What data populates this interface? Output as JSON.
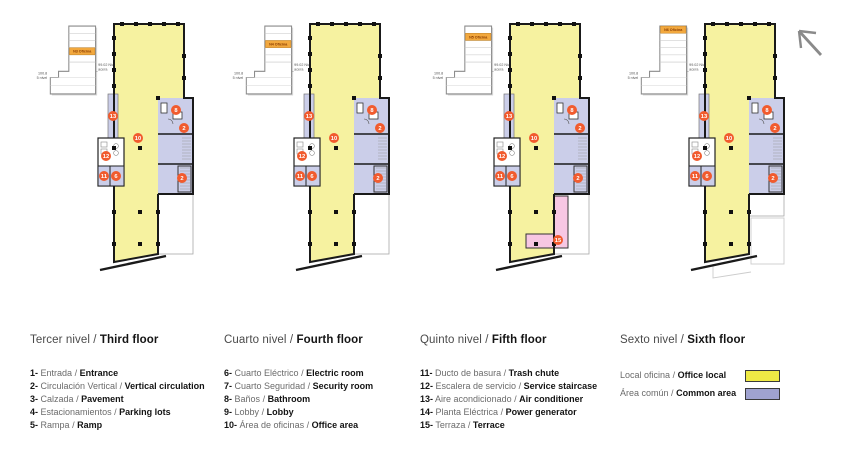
{
  "ui": {
    "separator": "/"
  },
  "colors": {
    "office_yellow": "#F6F2A0",
    "common_lavender": "#CBCEE9",
    "terrace_pink": "#F7C7E3",
    "marker_orange": "#F15B2E",
    "swatch_yellow": "#EFEA45",
    "swatch_lavender": "#9FA2D0",
    "wall": "#1a1a1a",
    "band_orange": "#F2A83E",
    "band_text": "#8a3c00"
  },
  "panels": [
    {
      "inset": {
        "band_label": "N3 Oficina",
        "left_label_1": "100.8",
        "left_label_2": "5 nivel",
        "right_label_1": "99.02 Nivel",
        "right_label_2": "acera"
      },
      "floor": 3,
      "terrace": false,
      "ghost": false,
      "markers": [
        {
          "n": "13",
          "x": 17,
          "y": 100
        },
        {
          "n": "12",
          "x": 10,
          "y": 140
        },
        {
          "n": "11",
          "x": 8,
          "y": 160
        },
        {
          "n": "6",
          "x": 20,
          "y": 160
        },
        {
          "n": "10",
          "x": 42,
          "y": 122
        },
        {
          "n": "8",
          "x": 80,
          "y": 94
        },
        {
          "n": "2",
          "x": 88,
          "y": 112
        },
        {
          "n": "2",
          "x": 86,
          "y": 162
        }
      ]
    },
    {
      "inset": {
        "band_label": "N4 Oficina",
        "left_label_1": "100.8",
        "left_label_2": "5 nivel",
        "right_label_1": "99.02 Nivel",
        "right_label_2": "acera"
      },
      "floor": 4,
      "terrace": false,
      "ghost": false,
      "markers": [
        {
          "n": "13",
          "x": 17,
          "y": 100
        },
        {
          "n": "12",
          "x": 10,
          "y": 140
        },
        {
          "n": "11",
          "x": 8,
          "y": 160
        },
        {
          "n": "6",
          "x": 20,
          "y": 160
        },
        {
          "n": "10",
          "x": 42,
          "y": 122
        },
        {
          "n": "8",
          "x": 80,
          "y": 94
        },
        {
          "n": "2",
          "x": 88,
          "y": 112
        },
        {
          "n": "2",
          "x": 86,
          "y": 162
        }
      ]
    },
    {
      "inset": {
        "band_label": "N5 Oficina",
        "left_label_1": "100.8",
        "left_label_2": "5 nivel",
        "right_label_1": "99.02 Nivel",
        "right_label_2": "acera"
      },
      "floor": 5,
      "terrace": true,
      "ghost": false,
      "markers": [
        {
          "n": "13",
          "x": 17,
          "y": 100
        },
        {
          "n": "12",
          "x": 10,
          "y": 140
        },
        {
          "n": "11",
          "x": 8,
          "y": 160
        },
        {
          "n": "6",
          "x": 20,
          "y": 160
        },
        {
          "n": "10",
          "x": 42,
          "y": 122
        },
        {
          "n": "8",
          "x": 80,
          "y": 94
        },
        {
          "n": "2",
          "x": 88,
          "y": 112
        },
        {
          "n": "2",
          "x": 86,
          "y": 162
        },
        {
          "n": "15",
          "x": 66,
          "y": 224
        }
      ]
    },
    {
      "inset": {
        "band_label": "N6 Oficina",
        "left_label_1": "100.8",
        "left_label_2": "5 nivel",
        "right_label_1": "99.02 Nivel",
        "right_label_2": "acera"
      },
      "floor": 6,
      "terrace": false,
      "ghost": true,
      "markers": [
        {
          "n": "13",
          "x": 17,
          "y": 100
        },
        {
          "n": "12",
          "x": 10,
          "y": 140
        },
        {
          "n": "11",
          "x": 8,
          "y": 160
        },
        {
          "n": "6",
          "x": 20,
          "y": 160
        },
        {
          "n": "10",
          "x": 42,
          "y": 122
        },
        {
          "n": "8",
          "x": 80,
          "y": 94
        },
        {
          "n": "2",
          "x": 88,
          "y": 112
        },
        {
          "n": "2",
          "x": 86,
          "y": 162
        }
      ]
    }
  ],
  "legend": {
    "columns": [
      {
        "title_es": "Tercer nivel",
        "title_en": "Third floor",
        "items": [
          {
            "num": "1-",
            "es": "Entrada",
            "en": "Entrance"
          },
          {
            "num": "2-",
            "es": "Circulación Vertical",
            "en": "Vertical circulation"
          },
          {
            "num": "3-",
            "es": "Calzada",
            "en": "Pavement"
          },
          {
            "num": "4-",
            "es": "Estacionamientos",
            "en": "Parking lots"
          },
          {
            "num": "5-",
            "es": "Rampa",
            "en": "Ramp"
          }
        ]
      },
      {
        "title_es": "Cuarto nivel",
        "title_en": "Fourth floor",
        "items": [
          {
            "num": "6-",
            "es": "Cuarto Eléctrico",
            "en": "Electric room"
          },
          {
            "num": "7-",
            "es": "Cuarto Seguridad",
            "en": "Security room"
          },
          {
            "num": "8-",
            "es": "Baños",
            "en": "Bathroom"
          },
          {
            "num": "9-",
            "es": "Lobby",
            "en": "Lobby"
          },
          {
            "num": "10-",
            "es": "Área de oficinas",
            "en": "Office area"
          }
        ]
      },
      {
        "title_es": "Quinto nivel",
        "title_en": "Fifth floor",
        "items": [
          {
            "num": "11-",
            "es": "Ducto de basura",
            "en": "Trash chute"
          },
          {
            "num": "12-",
            "es": "Escalera de servicio",
            "en": "Service staircase"
          },
          {
            "num": "13-",
            "es": "Aire acondicionado",
            "en": "Air conditioner"
          },
          {
            "num": "14-",
            "es": "Planta Eléctrica",
            "en": "Power generator"
          },
          {
            "num": "15-",
            "es": "Terraza",
            "en": "Terrace"
          }
        ]
      },
      {
        "title_es": "Sexto nivel",
        "title_en": "Sixth floor",
        "swatches": [
          {
            "es": "Local oficina",
            "en": "Office local",
            "color_key": "swatch_yellow"
          },
          {
            "es": "Área común",
            "en": "Common area",
            "color_key": "swatch_lavender"
          }
        ]
      }
    ]
  }
}
